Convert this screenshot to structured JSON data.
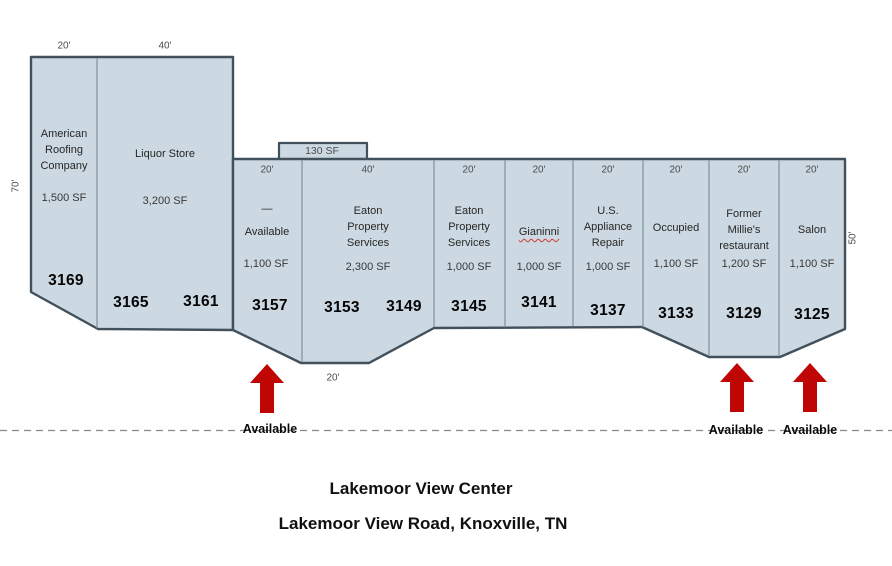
{
  "title": {
    "line1": "Lakemoor View Center",
    "line2": "Lakemoor View Road, Knoxville, TN"
  },
  "site_plan": {
    "mezzanine_sf": "130 SF",
    "left_depth": "70'",
    "right_depth": "50'",
    "bottom_frontage": "20'",
    "available_label": "Available",
    "colors": {
      "unit_fill": "#ccd9e2",
      "outline": "#41505a",
      "divider": "#7e939e",
      "arrow_red": "#c00505"
    },
    "units": [
      {
        "number": "3169",
        "name": "American\nRoofing\nCompany",
        "sf": "1,500 SF",
        "width_label": "20'"
      },
      {
        "name": "Liquor Store",
        "sf": "3,200 SF",
        "numbers": [
          "3165",
          "3161"
        ],
        "width_label": "40'"
      },
      {
        "number": "3157",
        "name": "—\nAvailable",
        "sf": "1,100 SF",
        "width_label": "20'"
      },
      {
        "name": "Eaton\nProperty\nServices",
        "sf": "2,300 SF",
        "numbers": [
          "3153",
          "3149"
        ],
        "width_label": "40'"
      },
      {
        "number": "3145",
        "name": "Eaton\nProperty\nServices",
        "sf": "1,000 SF",
        "width_label": "20'"
      },
      {
        "number": "3141",
        "name": "Gianinni",
        "sf": "1,000 SF",
        "width_label": "20'"
      },
      {
        "number": "3137",
        "name": "U.S.\nAppliance\nRepair",
        "sf": "1,000 SF",
        "width_label": "20'"
      },
      {
        "number": "3133",
        "name": "Occupied",
        "sf": "1,100 SF",
        "width_label": "20'"
      },
      {
        "number": "3129",
        "name": "Former\nMillie's\nrestaurant",
        "sf": "1,200 SF",
        "width_label": "20'"
      },
      {
        "number": "3125",
        "name": "Salon",
        "sf": "1,100 SF",
        "width_label": "20'"
      }
    ]
  }
}
